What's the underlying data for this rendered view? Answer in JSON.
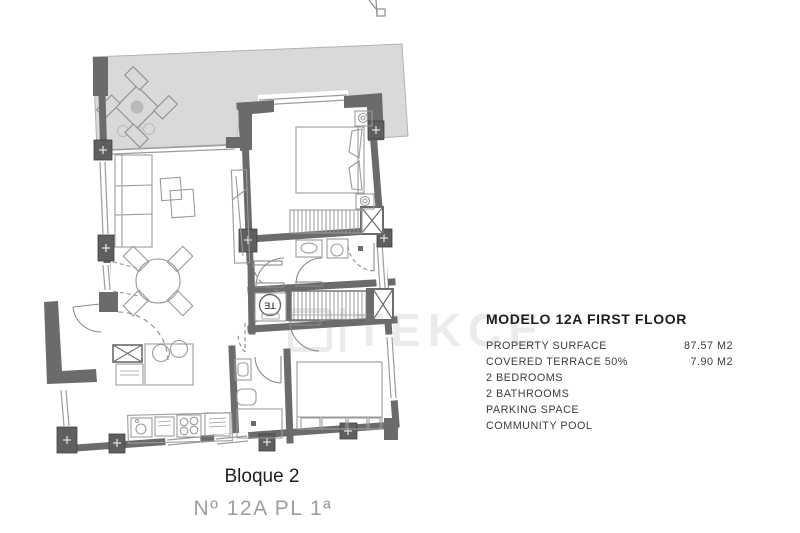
{
  "panel": {
    "title": "MODELO 12A FIRST FLOOR",
    "rows": [
      {
        "label": "PROPERTY SURFACE",
        "value": "87.57 M2"
      },
      {
        "label": "COVERED TERRACE 50%",
        "value": "7.90 M2"
      },
      {
        "label": "2 BEDROOMS",
        "value": ""
      },
      {
        "label": "2 BATHROOMS",
        "value": ""
      },
      {
        "label": "PARKING SPACE",
        "value": ""
      },
      {
        "label": "COMMUNITY POOL",
        "value": ""
      }
    ]
  },
  "footer": {
    "block_label": "Bloque 2",
    "unit_label": "Nº 12A PL 1ª"
  },
  "watermark": {
    "text": "TEKCE"
  },
  "plan": {
    "te_label": "TE"
  },
  "colors": {
    "wall": "#6b6b6b",
    "terrace_fill": "#d9d9d9",
    "furniture_line": "#9a9a9a",
    "title_text": "#1c1c1c",
    "body_text": "#3c3c3c",
    "unit_text": "#9e9e9e"
  }
}
